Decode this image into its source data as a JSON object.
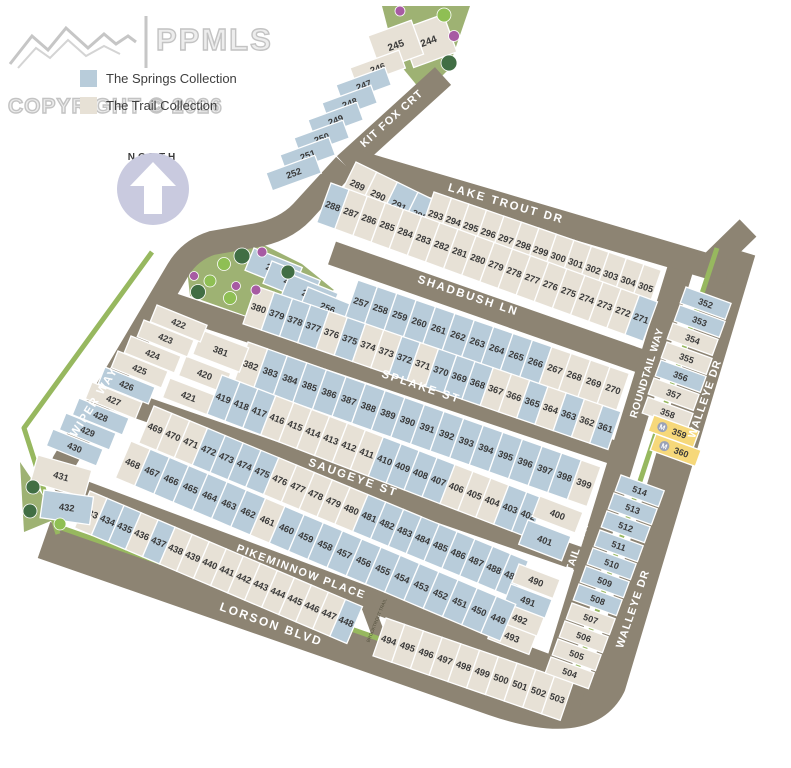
{
  "watermark": {
    "brand": "PPMLS",
    "copyright": "COPYRIGHT © 2026"
  },
  "legend": [
    {
      "id": "springs",
      "label": "The Springs Collection"
    },
    {
      "id": "trail",
      "label": "The Trail Collection"
    }
  ],
  "north": {
    "label": "NORTH"
  },
  "model_marker": "M",
  "colors": {
    "springs": "#b8ccda",
    "trail": "#e7e1d6",
    "model": "#f6d87a",
    "road": "#8d8473",
    "park": "#9eb273",
    "strip": "#97b85f",
    "tree_dark": "#416e44",
    "tree_light": "#8fbf54",
    "bush": "#a75ba3"
  },
  "streets": {
    "kit_fox": "KIT FOX CRT",
    "lake_trout": "LAKE TROUT DR",
    "shadbush": "SHADBUSH LN",
    "splake": "SPLAKE ST",
    "saugeye": "SAUGEYE ST",
    "pikeminnow": "PIKEMINNOW PLACE",
    "lorson": "LORSON BLVD",
    "wiper": "WIPER WAY",
    "roundtail": "ROUNDTAIL WAY",
    "walleye": "WALLEYE DR",
    "brooktrout": "BROOKTROUT TRAIL"
  },
  "lot_rows": [
    {
      "id": "top_cells",
      "lots": [
        {
          "n": 244,
          "c": "trail"
        },
        {
          "n": 245,
          "c": "trail"
        }
      ]
    },
    {
      "id": "kitfox_col",
      "lots": [
        {
          "n": 246,
          "c": "trail"
        },
        {
          "n": 247,
          "c": "springs"
        },
        {
          "n": 248,
          "c": "springs"
        },
        {
          "n": 249,
          "c": "springs"
        },
        {
          "n": 250,
          "c": "springs"
        },
        {
          "n": 251,
          "c": "springs"
        },
        {
          "n": 252,
          "c": "springs"
        }
      ]
    },
    {
      "id": "lake_trout_west",
      "lots": [
        {
          "n": 289,
          "c": "trail"
        },
        {
          "n": 290,
          "c": "trail"
        },
        {
          "n": 291,
          "c": "springs"
        },
        {
          "n": 292,
          "c": "springs"
        }
      ]
    },
    {
      "id": "lake_trout_east",
      "lots": [
        {
          "n": 293,
          "c": "trail"
        },
        {
          "n": 294,
          "c": "trail"
        },
        {
          "n": 295,
          "c": "trail"
        },
        {
          "n": 296,
          "c": "trail"
        },
        {
          "n": 297,
          "c": "trail"
        },
        {
          "n": 298,
          "c": "trail"
        },
        {
          "n": 299,
          "c": "trail"
        },
        {
          "n": 300,
          "c": "trail"
        },
        {
          "n": 301,
          "c": "trail"
        },
        {
          "n": 302,
          "c": "trail"
        },
        {
          "n": 303,
          "c": "trail"
        },
        {
          "n": 304,
          "c": "trail"
        },
        {
          "n": 305,
          "c": "trail"
        }
      ]
    },
    {
      "id": "shadbush_north",
      "lots": [
        {
          "n": 288,
          "c": "springs"
        },
        {
          "n": 287,
          "c": "trail"
        },
        {
          "n": 286,
          "c": "trail"
        },
        {
          "n": 285,
          "c": "trail"
        },
        {
          "n": 284,
          "c": "trail"
        },
        {
          "n": 283,
          "c": "trail"
        },
        {
          "n": 282,
          "c": "trail"
        },
        {
          "n": 281,
          "c": "trail"
        },
        {
          "n": 280,
          "c": "trail"
        },
        {
          "n": 279,
          "c": "trail"
        },
        {
          "n": 278,
          "c": "trail"
        },
        {
          "n": 277,
          "c": "trail"
        },
        {
          "n": 276,
          "c": "trail"
        },
        {
          "n": 275,
          "c": "trail"
        },
        {
          "n": 274,
          "c": "trail"
        },
        {
          "n": 273,
          "c": "trail"
        },
        {
          "n": 272,
          "c": "trail"
        },
        {
          "n": 271,
          "c": "springs"
        }
      ]
    },
    {
      "id": "west_stairs",
      "lots": [
        {
          "n": 253,
          "c": "springs"
        },
        {
          "n": 254,
          "c": "springs"
        },
        {
          "n": 255,
          "c": "springs"
        },
        {
          "n": 256,
          "c": "springs"
        }
      ]
    },
    {
      "id": "shadbush_south",
      "lots": [
        {
          "n": 257,
          "c": "springs"
        },
        {
          "n": 258,
          "c": "springs"
        },
        {
          "n": 259,
          "c": "springs"
        },
        {
          "n": 260,
          "c": "springs"
        },
        {
          "n": 261,
          "c": "springs"
        },
        {
          "n": 262,
          "c": "springs"
        },
        {
          "n": 263,
          "c": "springs"
        },
        {
          "n": 264,
          "c": "springs"
        },
        {
          "n": 265,
          "c": "springs"
        },
        {
          "n": 266,
          "c": "springs"
        },
        {
          "n": 267,
          "c": "trail"
        },
        {
          "n": 268,
          "c": "trail"
        },
        {
          "n": 269,
          "c": "trail"
        },
        {
          "n": 270,
          "c": "trail"
        }
      ]
    },
    {
      "id": "splake_north",
      "lots": [
        {
          "n": 380,
          "c": "trail"
        },
        {
          "n": 379,
          "c": "springs"
        },
        {
          "n": 378,
          "c": "springs"
        },
        {
          "n": 377,
          "c": "springs"
        },
        {
          "n": 376,
          "c": "trail"
        },
        {
          "n": 375,
          "c": "springs"
        },
        {
          "n": 374,
          "c": "trail"
        },
        {
          "n": 373,
          "c": "trail"
        },
        {
          "n": 372,
          "c": "springs"
        },
        {
          "n": 371,
          "c": "trail"
        },
        {
          "n": 370,
          "c": "springs"
        },
        {
          "n": 369,
          "c": "springs"
        },
        {
          "n": 368,
          "c": "springs"
        },
        {
          "n": 367,
          "c": "trail"
        },
        {
          "n": 366,
          "c": "trail"
        },
        {
          "n": 365,
          "c": "springs"
        },
        {
          "n": 364,
          "c": "trail"
        },
        {
          "n": 363,
          "c": "springs"
        },
        {
          "n": 362,
          "c": "trail"
        },
        {
          "n": 361,
          "c": "springs"
        }
      ]
    },
    {
      "id": "splake_south",
      "lots": [
        {
          "n": 382,
          "c": "trail"
        },
        {
          "n": 383,
          "c": "springs"
        },
        {
          "n": 384,
          "c": "springs"
        },
        {
          "n": 385,
          "c": "springs"
        },
        {
          "n": 386,
          "c": "springs"
        },
        {
          "n": 387,
          "c": "springs"
        },
        {
          "n": 388,
          "c": "springs"
        },
        {
          "n": 389,
          "c": "springs"
        },
        {
          "n": 390,
          "c": "springs"
        },
        {
          "n": 391,
          "c": "springs"
        },
        {
          "n": 392,
          "c": "springs"
        },
        {
          "n": 393,
          "c": "springs"
        },
        {
          "n": 394,
          "c": "springs"
        },
        {
          "n": 395,
          "c": "springs"
        },
        {
          "n": 396,
          "c": "springs"
        },
        {
          "n": 397,
          "c": "springs"
        },
        {
          "n": 398,
          "c": "springs"
        },
        {
          "n": 399,
          "c": "trail"
        }
      ]
    },
    {
      "id": "wiper_corner",
      "lots": [
        {
          "n": 381,
          "c": "trail"
        },
        {
          "n": 420,
          "c": "trail"
        },
        {
          "n": 421,
          "c": "trail"
        }
      ]
    },
    {
      "id": "saugeye_north",
      "lots": [
        {
          "n": 419,
          "c": "springs"
        },
        {
          "n": 418,
          "c": "springs"
        },
        {
          "n": 417,
          "c": "springs"
        },
        {
          "n": 416,
          "c": "trail"
        },
        {
          "n": 415,
          "c": "trail"
        },
        {
          "n": 414,
          "c": "trail"
        },
        {
          "n": 413,
          "c": "trail"
        },
        {
          "n": 412,
          "c": "trail"
        },
        {
          "n": 411,
          "c": "trail"
        },
        {
          "n": 410,
          "c": "springs"
        },
        {
          "n": 409,
          "c": "springs"
        },
        {
          "n": 408,
          "c": "springs"
        },
        {
          "n": 407,
          "c": "springs"
        },
        {
          "n": 406,
          "c": "trail"
        },
        {
          "n": 405,
          "c": "trail"
        },
        {
          "n": 404,
          "c": "trail"
        },
        {
          "n": 403,
          "c": "springs"
        },
        {
          "n": 402,
          "c": "springs"
        }
      ]
    },
    {
      "id": "stack_400_401",
      "lots": [
        {
          "n": 400,
          "c": "trail"
        },
        {
          "n": 401,
          "c": "springs"
        }
      ]
    },
    {
      "id": "saugeye_south",
      "lots": [
        {
          "n": 469,
          "c": "trail"
        },
        {
          "n": 470,
          "c": "trail"
        },
        {
          "n": 471,
          "c": "trail"
        },
        {
          "n": 472,
          "c": "springs"
        },
        {
          "n": 473,
          "c": "springs"
        },
        {
          "n": 474,
          "c": "springs"
        },
        {
          "n": 475,
          "c": "springs"
        },
        {
          "n": 476,
          "c": "trail"
        },
        {
          "n": 477,
          "c": "trail"
        },
        {
          "n": 478,
          "c": "trail"
        },
        {
          "n": 479,
          "c": "trail"
        },
        {
          "n": 480,
          "c": "trail"
        },
        {
          "n": 481,
          "c": "springs"
        },
        {
          "n": 482,
          "c": "springs"
        },
        {
          "n": 483,
          "c": "springs"
        },
        {
          "n": 484,
          "c": "springs"
        },
        {
          "n": 485,
          "c": "springs"
        },
        {
          "n": 486,
          "c": "springs"
        },
        {
          "n": 487,
          "c": "springs"
        },
        {
          "n": 488,
          "c": "springs"
        },
        {
          "n": 489,
          "c": "springs"
        }
      ]
    },
    {
      "id": "stack_490_493",
      "lots": [
        {
          "n": 490,
          "c": "trail"
        },
        {
          "n": 491,
          "c": "springs"
        },
        {
          "n": 492,
          "c": "trail"
        },
        {
          "n": 493,
          "c": "trail"
        }
      ]
    },
    {
      "id": "pikeminnow_north",
      "lots": [
        {
          "n": 468,
          "c": "trail"
        },
        {
          "n": 467,
          "c": "springs"
        },
        {
          "n": 466,
          "c": "springs"
        },
        {
          "n": 465,
          "c": "springs"
        },
        {
          "n": 464,
          "c": "springs"
        },
        {
          "n": 463,
          "c": "springs"
        },
        {
          "n": 462,
          "c": "springs"
        },
        {
          "n": 461,
          "c": "trail"
        },
        {
          "n": 460,
          "c": "springs"
        },
        {
          "n": 459,
          "c": "springs"
        },
        {
          "n": 458,
          "c": "springs"
        },
        {
          "n": 457,
          "c": "springs"
        },
        {
          "n": 456,
          "c": "springs"
        },
        {
          "n": 455,
          "c": "springs"
        },
        {
          "n": 454,
          "c": "springs"
        },
        {
          "n": 453,
          "c": "springs"
        },
        {
          "n": 452,
          "c": "springs"
        },
        {
          "n": 451,
          "c": "springs"
        },
        {
          "n": 450,
          "c": "springs"
        },
        {
          "n": 449,
          "c": "springs"
        }
      ]
    },
    {
      "id": "lorson_row_west",
      "lots": [
        {
          "n": 433,
          "c": "trail"
        },
        {
          "n": 434,
          "c": "springs"
        },
        {
          "n": 435,
          "c": "springs"
        },
        {
          "n": 436,
          "c": "trail"
        },
        {
          "n": 437,
          "c": "springs"
        },
        {
          "n": 438,
          "c": "trail"
        },
        {
          "n": 439,
          "c": "trail"
        },
        {
          "n": 440,
          "c": "trail"
        },
        {
          "n": 441,
          "c": "trail"
        },
        {
          "n": 442,
          "c": "trail"
        },
        {
          "n": 443,
          "c": "trail"
        },
        {
          "n": 444,
          "c": "trail"
        },
        {
          "n": 445,
          "c": "trail"
        },
        {
          "n": 446,
          "c": "trail"
        },
        {
          "n": 447,
          "c": "trail"
        },
        {
          "n": 448,
          "c": "springs"
        }
      ]
    },
    {
      "id": "lorson_row_east",
      "lots": [
        {
          "n": 494,
          "c": "trail"
        },
        {
          "n": 495,
          "c": "trail"
        },
        {
          "n": 496,
          "c": "trail"
        },
        {
          "n": 497,
          "c": "trail"
        },
        {
          "n": 498,
          "c": "trail"
        },
        {
          "n": 499,
          "c": "trail"
        },
        {
          "n": 500,
          "c": "trail"
        },
        {
          "n": 501,
          "c": "trail"
        },
        {
          "n": 502,
          "c": "trail"
        },
        {
          "n": 503,
          "c": "trail"
        }
      ]
    },
    {
      "id": "wiper_col",
      "lots": [
        {
          "n": 422,
          "c": "trail"
        },
        {
          "n": 423,
          "c": "trail"
        },
        {
          "n": 424,
          "c": "trail"
        },
        {
          "n": 425,
          "c": "trail"
        },
        {
          "n": 426,
          "c": "springs"
        },
        {
          "n": 427,
          "c": "trail"
        },
        {
          "n": 428,
          "c": "springs"
        },
        {
          "n": 429,
          "c": "springs"
        },
        {
          "n": 430,
          "c": "springs"
        },
        {
          "n": 431,
          "c": "trail"
        },
        {
          "n": 432,
          "c": "springs"
        }
      ]
    },
    {
      "id": "walleye_col_north",
      "lots": [
        {
          "n": 352,
          "c": "springs"
        },
        {
          "n": 353,
          "c": "springs"
        },
        {
          "n": 354,
          "c": "trail"
        },
        {
          "n": 355,
          "c": "trail"
        },
        {
          "n": 356,
          "c": "springs"
        },
        {
          "n": 357,
          "c": "trail"
        },
        {
          "n": 358,
          "c": "trail"
        },
        {
          "n": 359,
          "c": "model"
        },
        {
          "n": 360,
          "c": "model"
        }
      ]
    },
    {
      "id": "walleye_col_south",
      "lots": [
        {
          "n": 514,
          "c": "springs"
        },
        {
          "n": 513,
          "c": "springs"
        },
        {
          "n": 512,
          "c": "springs"
        },
        {
          "n": 511,
          "c": "springs"
        },
        {
          "n": 510,
          "c": "springs"
        },
        {
          "n": 509,
          "c": "springs"
        },
        {
          "n": 508,
          "c": "springs"
        },
        {
          "n": 507,
          "c": "trail"
        },
        {
          "n": 506,
          "c": "trail"
        },
        {
          "n": 505,
          "c": "trail"
        },
        {
          "n": 504,
          "c": "trail"
        }
      ]
    }
  ]
}
